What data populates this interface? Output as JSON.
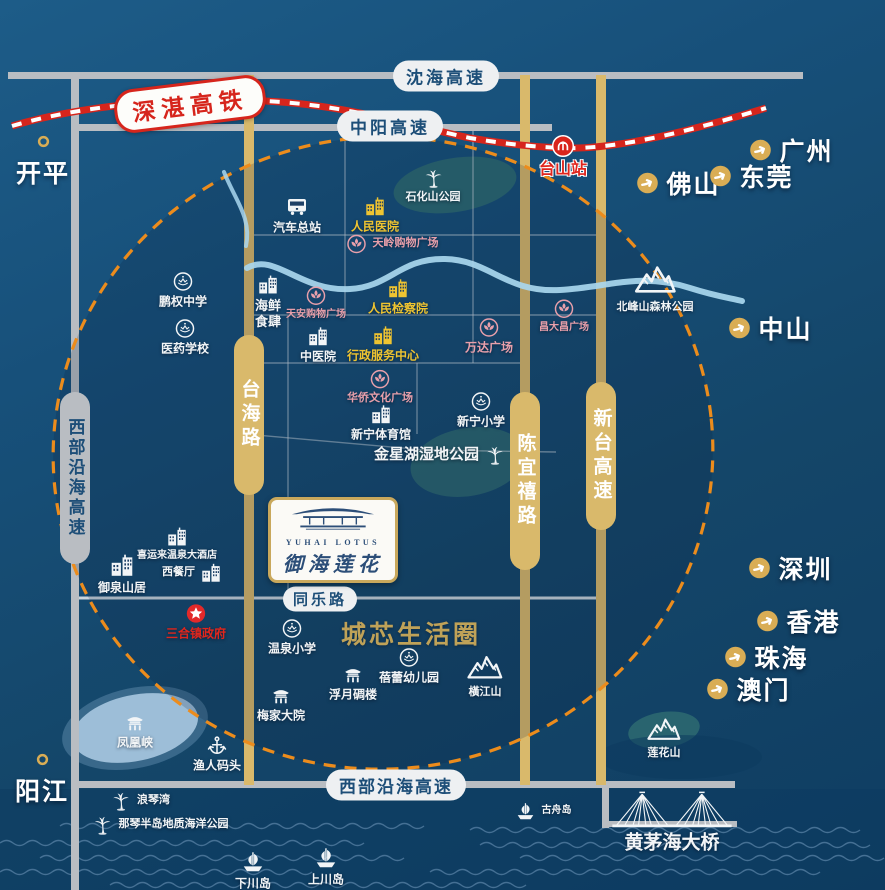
{
  "brand": {
    "en": "YUHAI LOTUS",
    "cn": "御海莲花"
  },
  "railway": {
    "line": "深湛高铁",
    "station": "台山站"
  },
  "roads": {
    "shenhai": "沈海高速",
    "zhongyang": "中阳高速",
    "xibu_west": "西部沿海高速",
    "xibu_south": "西部沿海高速",
    "taihai": "台海路",
    "chenyixi": "陈宜禧路",
    "xintai": "新台高速",
    "tongle": "同乐路"
  },
  "zone_label": "城芯生活圈",
  "colors": {
    "gold_road": "#d9b96b",
    "gray_road": "#b9bdc2",
    "accent_gold": "#c9a85c",
    "railway_red": "#d6251c",
    "landmark_yellow": "#eec431",
    "landmark_pink": "#e9a0ab",
    "label_red": "#e0261d",
    "dashed_orange": "#ec8c1c"
  },
  "cities": [
    {
      "label": "开平",
      "marker": "ring",
      "x": 43,
      "y": 162
    },
    {
      "label": "阳江",
      "marker": "ring",
      "x": 42,
      "y": 780
    },
    {
      "label": "广州",
      "marker": "arrow",
      "x": 791,
      "y": 150
    },
    {
      "label": "佛山",
      "marker": "arrow",
      "x": 678,
      "y": 183
    },
    {
      "label": "东莞",
      "marker": "arrow",
      "x": 751,
      "y": 176
    },
    {
      "label": "中山",
      "marker": "arrow",
      "x": 770,
      "y": 328
    },
    {
      "label": "深圳",
      "marker": "arrow",
      "x": 790,
      "y": 568
    },
    {
      "label": "香港",
      "marker": "arrow",
      "x": 798,
      "y": 621
    },
    {
      "label": "珠海",
      "marker": "arrow",
      "x": 766,
      "y": 657
    },
    {
      "label": "澳门",
      "marker": "arrow",
      "x": 748,
      "y": 689
    }
  ],
  "landmarks": [
    {
      "label": "汽车总站",
      "icon": "bus",
      "x": 297,
      "y": 215,
      "s": 24
    },
    {
      "label": "人民医院",
      "icon": "building",
      "color": "yellow",
      "x": 375,
      "y": 215
    },
    {
      "label": "石化山公园",
      "icon": "palm",
      "x": 433,
      "y": 186,
      "fs": 11
    },
    {
      "label": "台山站",
      "icon": "rail",
      "color": "red",
      "x": 563,
      "y": 157,
      "s": 24,
      "fs": 16,
      "outline": true
    },
    {
      "label": "天岭购物广场",
      "icon": "plaza",
      "color": "pink",
      "x": 392,
      "y": 244,
      "layout": "right",
      "fs": 11
    },
    {
      "label": "人民检察院",
      "icon": "building",
      "color": "yellow",
      "x": 398,
      "y": 297
    },
    {
      "label": "鹏权中学",
      "icon": "badge",
      "x": 183,
      "y": 290
    },
    {
      "label": "医药学校",
      "icon": "badge",
      "x": 185,
      "y": 337
    },
    {
      "label": "海鲜\n食肆",
      "icon": "building",
      "x": 268,
      "y": 302,
      "fs": 13
    },
    {
      "label": "天安购物广场",
      "icon": "plaza",
      "color": "pink",
      "x": 316,
      "y": 303,
      "fs": 10
    },
    {
      "label": "中医院",
      "icon": "building",
      "x": 318,
      "y": 345
    },
    {
      "label": "行政服务中心",
      "icon": "building",
      "color": "yellow",
      "x": 383,
      "y": 344
    },
    {
      "label": "万达广场",
      "icon": "plaza",
      "color": "pink",
      "x": 489,
      "y": 336
    },
    {
      "label": "昌大昌广场",
      "icon": "plaza",
      "color": "pink",
      "x": 564,
      "y": 316,
      "fs": 10
    },
    {
      "label": "北峰山森林公园",
      "icon": "mountain",
      "x": 655,
      "y": 286,
      "s": 42,
      "fs": 11
    },
    {
      "label": "华侨文化广场",
      "icon": "plaza",
      "color": "pink",
      "x": 380,
      "y": 387,
      "fs": 11
    },
    {
      "label": "新宁体育馆",
      "icon": "building",
      "x": 381,
      "y": 423
    },
    {
      "label": "新宁小学",
      "icon": "badge",
      "x": 481,
      "y": 410
    },
    {
      "label": "金星湖湿地公园",
      "icon": "palm",
      "x": 440,
      "y": 455,
      "layout": "left",
      "fs": 15
    },
    {
      "label": "御泉山居",
      "icon": "building",
      "x": 122,
      "y": 574,
      "s": 26
    },
    {
      "label": "喜运来温泉大酒店",
      "icon": "building",
      "x": 177,
      "y": 544,
      "fs": 10
    },
    {
      "label": "西餐厅",
      "icon": "building",
      "x": 192,
      "y": 573,
      "layout": "left",
      "fs": 11
    },
    {
      "label": "三合镇政府",
      "icon": "star",
      "color": "red",
      "x": 196,
      "y": 622
    },
    {
      "label": "温泉小学",
      "icon": "badge",
      "x": 292,
      "y": 637
    },
    {
      "label": "蓓蕾幼儿园",
      "icon": "badge",
      "x": 409,
      "y": 666
    },
    {
      "label": "橫江山",
      "icon": "mountain",
      "x": 485,
      "y": 674,
      "s": 36,
      "fs": 11
    },
    {
      "label": "浮月碉楼",
      "icon": "pagoda",
      "x": 353,
      "y": 683
    },
    {
      "label": "梅家大院",
      "icon": "pagoda",
      "x": 281,
      "y": 704
    },
    {
      "label": "凤凰峡",
      "icon": "pagoda",
      "x": 135,
      "y": 731
    },
    {
      "label": "渔人码头",
      "icon": "anchor",
      "x": 217,
      "y": 754
    },
    {
      "label": "浪琴湾",
      "icon": "palm",
      "x": 140,
      "y": 801,
      "layout": "right",
      "fs": 11
    },
    {
      "label": "那琴半岛地质海洋公园",
      "icon": "palm",
      "x": 160,
      "y": 825,
      "layout": "right",
      "fs": 11
    },
    {
      "label": "下川岛",
      "icon": "boat",
      "x": 253,
      "y": 870,
      "s": 26
    },
    {
      "label": "上川岛",
      "icon": "boat",
      "x": 326,
      "y": 866,
      "s": 26
    },
    {
      "label": "古舟岛",
      "icon": "boat",
      "x": 543,
      "y": 811,
      "layout": "right",
      "fs": 10
    },
    {
      "label": "莲花山",
      "icon": "mountain",
      "x": 664,
      "y": 736,
      "s": 34,
      "fs": 11
    },
    {
      "label": "黄茅海大桥",
      "icon": "bridge",
      "x": 672,
      "y": 822,
      "s": 124,
      "fs": 19
    }
  ]
}
